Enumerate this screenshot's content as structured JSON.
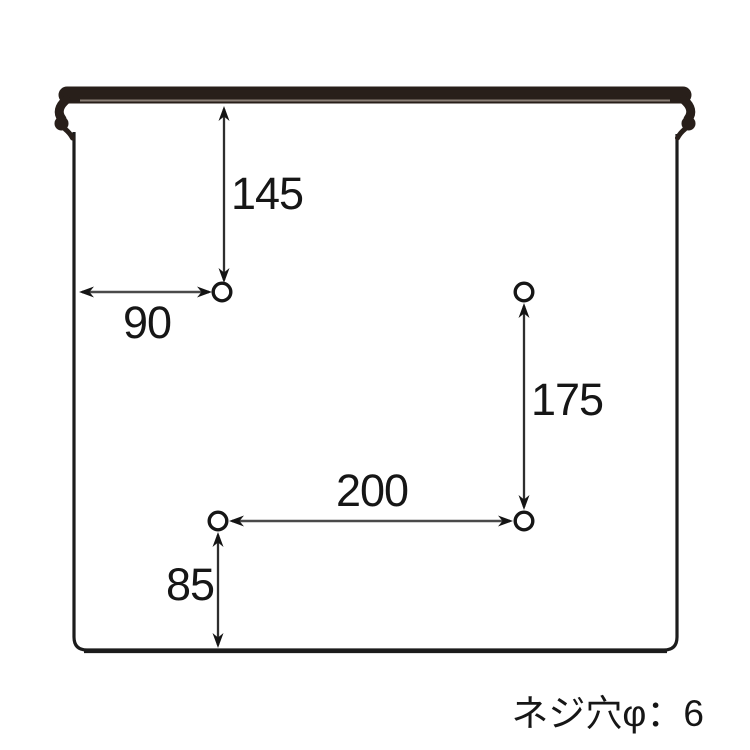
{
  "figure": {
    "type": "technical-dimension-diagram",
    "background_color": "#ffffff",
    "line_color": "#1c1c1c",
    "rail_color": "#281f1a",
    "note": "ネジ穴φ：6",
    "holes": {
      "count": 4,
      "screw_hole_diameter": "6"
    },
    "dimensions": {
      "hole_top_offset": "145",
      "hole_left_offset": "90",
      "right_holes_vertical_spacing": "175",
      "bottom_holes_horizontal_spacing": "200",
      "hole_bottom_offset": "85"
    }
  }
}
